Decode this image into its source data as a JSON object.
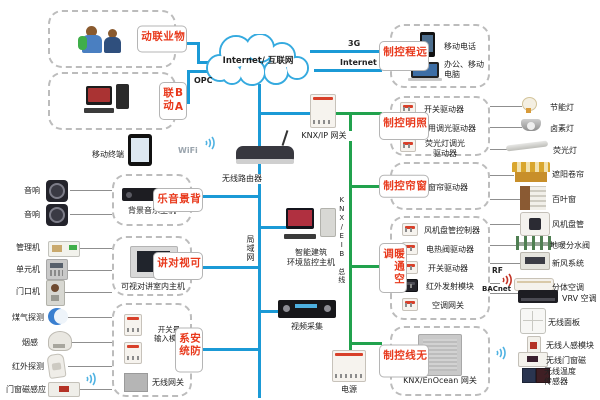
{
  "colors": {
    "line_blue": "#1b9ad6",
    "line_green": "#21a24d",
    "label_red": "#e8391c"
  },
  "cloud": {
    "label": "Internet/ 互联网"
  },
  "net": {
    "g3": "3G",
    "internet": "Internet",
    "opc": "OPC",
    "wifi": "WiFi",
    "lan": "局域网",
    "knx_bus": "KNX/EIB 总线",
    "rf": "RF",
    "bacnet": "BACnet"
  },
  "left": {
    "property": {
      "label": "物业联动"
    },
    "ba": {
      "label": "BA联动"
    },
    "mobile": {
      "label": "移动终端"
    },
    "music": {
      "label": "背景音乐",
      "host": "背景音乐主机",
      "speaker": "音响"
    },
    "intercom": {
      "label": "可视对讲",
      "host": "可视对讲室内主机",
      "mgr": "管理机",
      "unit": "单元机",
      "door": "门口机"
    },
    "security": {
      "label": "安防系统",
      "module": "开关量\n输入模块",
      "gateway": "无线网关",
      "gas": "煤气探测",
      "smoke": "烟感",
      "ir": "红外探测",
      "magnet": "门窗磁感应"
    }
  },
  "center": {
    "router": "无线路由器",
    "knx_ip": "KNX/IP 网关",
    "monitor": "智能建筑\n环境监控主机",
    "video": "视频采集",
    "power": "电源"
  },
  "right": {
    "remote": {
      "label": "远程控制",
      "phone": "移动电话",
      "pc": "办公、移动\n电脑"
    },
    "lighting": {
      "label": "照明控制",
      "rows": [
        {
          "driver": "开关驱动器",
          "device": "节能灯"
        },
        {
          "driver": "通用调光驱动器",
          "device": "卤素灯"
        },
        {
          "driver": "荧光灯调光\n驱动器",
          "device": "荧光灯"
        }
      ]
    },
    "curtain": {
      "label": "窗帘控制",
      "driver": "窗帘驱动器",
      "devices": [
        "遮阳卷帘",
        "百叶窗"
      ]
    },
    "hvac": {
      "label": "暖通空调",
      "rows": [
        {
          "driver": "风机盘管控制器",
          "device": "风机盘管"
        },
        {
          "driver": "电热阀驱动器",
          "device": "地暖分水阀"
        },
        {
          "driver": "开关驱动器",
          "device": "新风系统"
        },
        {
          "driver": "红外发射模块",
          "device": "分体空调"
        },
        {
          "driver": "空调网关",
          "device": "VRV 空调"
        }
      ]
    },
    "wireless": {
      "label": "无线控制",
      "gateway": "KNX/EnOcean 网关",
      "devices": [
        "无线面板",
        "无线人感模块",
        "无线门窗磁",
        "无线温度\n传感器"
      ]
    }
  }
}
